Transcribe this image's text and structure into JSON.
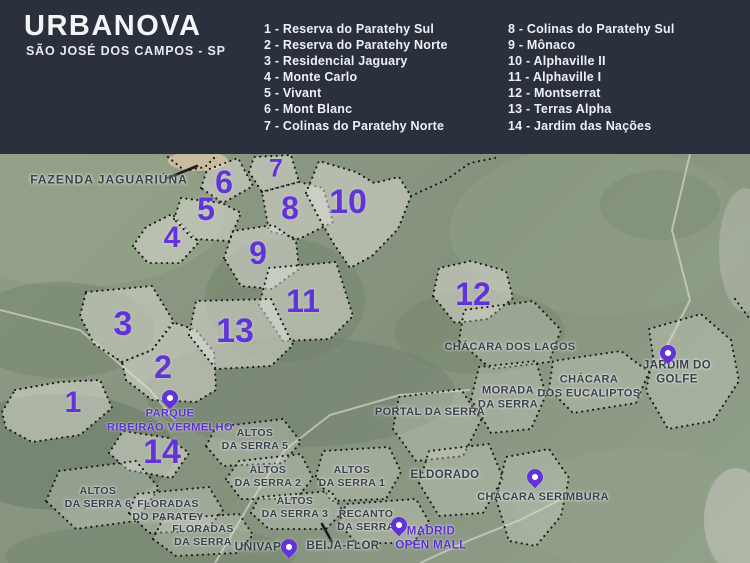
{
  "header": {
    "title": "URBANOVA",
    "subtitle": "SÃO JOSÉ DOS CAMPOS - SP"
  },
  "legend": {
    "column1": [
      "1 - Reserva do Paratehy Sul",
      "2 - Reserva do Paratehy Norte",
      "3 - Residencial Jaguary",
      "4 - Monte Carlo",
      "5 - Vivant",
      "6 - Mont Blanc",
      "7 - Colinas do Paratehy Norte"
    ],
    "column2": [
      "8 - Colinas do Paratehy Sul",
      "9 - Mônaco",
      "10 - Alphaville II",
      "11 - Alphaville I",
      "12 - Montserrat",
      "13 - Terras Alpha",
      "14 - Jardim das Nações"
    ]
  },
  "map": {
    "numbers": [
      "1",
      "2",
      "3",
      "4",
      "5",
      "6",
      "7",
      "8",
      "9",
      "10",
      "11",
      "12",
      "13",
      "14"
    ],
    "labels": {
      "fazenda_jaguariuna": "FAZENDA JAGUARIÚNA",
      "chacara_dos_lagos": "CHÁCARA DOS LAGOS",
      "morada_da_serra": "MORADA\nDA SERRA",
      "chacara_dos_eucaliptos": "CHÁCARA\nDOS EUCALIPTOS",
      "jardim_do_golfe": "JARDIM DO GOLFE",
      "portal_da_serra": "PORTAL DA SERRA",
      "eldorado": "ELDORADO",
      "altos_da_serra_5": "ALTOS\nDA SERRA 5",
      "altos_da_serra_2": "ALTOS\nDA SERRA 2",
      "altos_da_serra_1": "ALTOS\nDA SERRA 1",
      "altos_da_serra_3": "ALTOS\nDA SERRA 3",
      "recanto_da_serra": "RECANTO\nDA SERRA",
      "altos_da_serra_6": "ALTOS\nDA SERRA 6",
      "floradas_do_paratey": "FLORADAS\nDO PARATEY",
      "floradas_da_serra": "FLORADAS\nDA SERRA",
      "chacara_serimbura": "CHÁCARA SERIMBURA",
      "univap": "UNIVAP",
      "beija_flor": "BEIJA-FLOR",
      "parque_ribeirao_vermelho": "PARQUE\nRIBEIRÃO VERMELHO",
      "madrid_open_mall": "MADRID\nOPEN MALL"
    },
    "colors": {
      "header_bg": "#2a303c",
      "accent_purple": "#6233d9",
      "label_dark": "#3a404d"
    }
  }
}
